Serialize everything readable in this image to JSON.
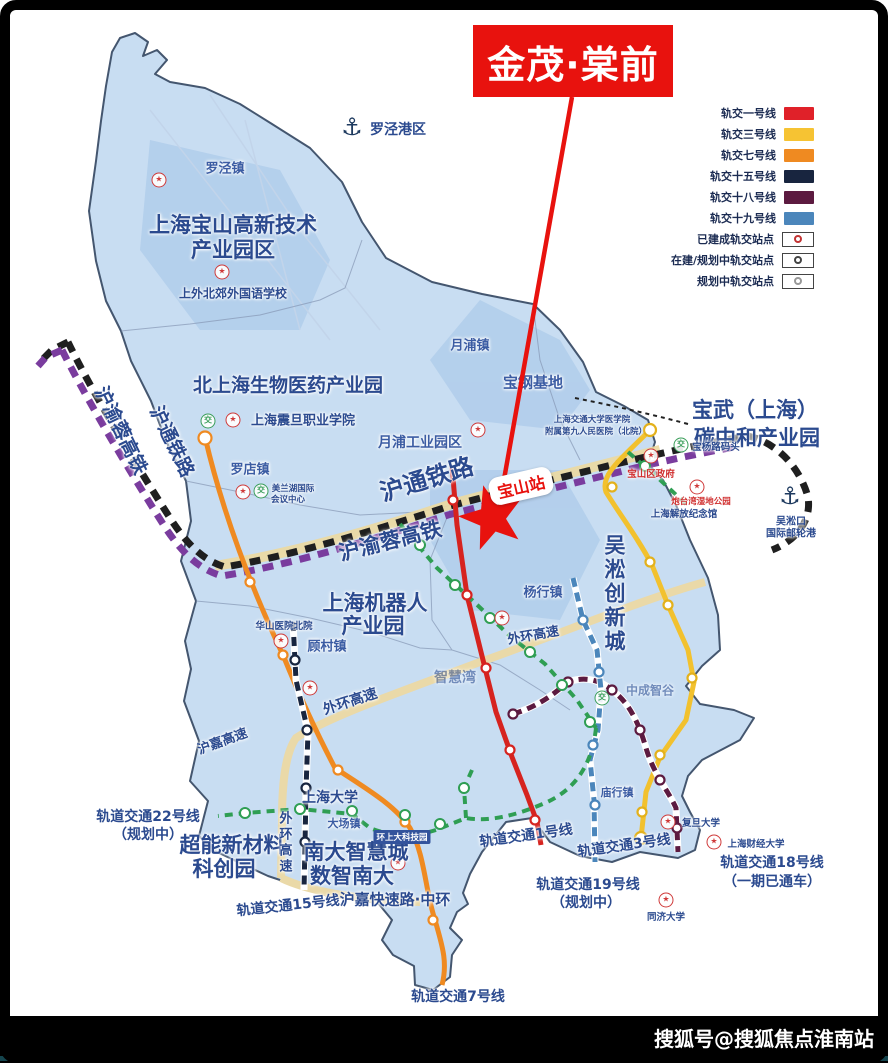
{
  "banner": {
    "title": "金茂·棠前"
  },
  "legend": {
    "lines": [
      {
        "label": "轨交一号线",
        "color": "#e02129"
      },
      {
        "label": "轨交三号线",
        "color": "#f6c333"
      },
      {
        "label": "轨交七号线",
        "color": "#ef8a21"
      },
      {
        "label": "轨交十五号线",
        "color": "#18253f"
      },
      {
        "label": "轨交十八号线",
        "color": "#5c1a40"
      },
      {
        "label": "轨交十九号线",
        "color": "#4b86bb"
      }
    ],
    "markers": [
      {
        "label": "已建成轨交站点"
      },
      {
        "label": "在建/规划中轨交站点"
      },
      {
        "label": "规划中轨交站点"
      }
    ]
  },
  "callout": {
    "station": "宝山站"
  },
  "parks": {
    "gaoxin1": "上海宝山高新技术",
    "gaoxin2": "产业园区",
    "biomed": "北上海生物医药产业园",
    "baowu1": "宝武（上海）",
    "baowu2": "碳中和产业园",
    "robot1": "上海机器人",
    "robot2": "产业园",
    "wusong": "吴淞创新城",
    "chaoneng1": "超能新材料",
    "chaoneng2": "科创园",
    "nanda1": "南大智慧城",
    "nanda2": "数智南大"
  },
  "towns": {
    "luojing": "罗泾镇",
    "luodian": "罗店镇",
    "yuepu": "月浦镇",
    "gucun": "顾村镇",
    "yanghang": "杨行镇",
    "dachang": "大场镇",
    "miaohang": "庙行镇"
  },
  "areas": {
    "baogang": "宝钢基地",
    "yuepu_park": "月浦工业园区",
    "zhihuiwan": "智慧湾",
    "zhongcheng": "中成智谷",
    "huanshangda": "环上大科技园"
  },
  "ports": {
    "luojing": "罗泾港区",
    "wusongkou1": "吴淞口",
    "wusongkou2": "国际邮轮港"
  },
  "railways": {
    "huyurong": "沪渝蓉高铁",
    "hutong": "沪通铁路"
  },
  "roads": {
    "waihuan": "外环高速",
    "hujia": "沪嘉高速",
    "zhonghuan": "沪嘉快速路·中环"
  },
  "metro": {
    "l22": "轨道交通22号线",
    "l22b": "（规划中）",
    "l15": "轨道交通15号线",
    "l7": "轨道交通7号线",
    "l1": "轨道交通1号线",
    "l3": "轨道交通3号线",
    "l19": "轨道交通19号线",
    "l19b": "（规划中）",
    "l18": "轨道交通18号线",
    "l18b": "（一期已通车）"
  },
  "pois": {
    "school": "上外北郊外国语学校",
    "college": "上海震旦职业学院",
    "meilan1": "美兰湖国际",
    "meilan2": "会议中心",
    "hosp1": "上海交通大学医学院",
    "hosp2": "附属第九人民医院（北院）",
    "gov": "宝山区政府",
    "huashan": "华山医院北院",
    "jiefang": "上海解放纪念馆",
    "baoyang": "宝杨路码头",
    "paotaiwan": "炮台湾湿地公园",
    "shu": "上海大学",
    "fudan": "复旦大学",
    "sufe": "上海财经大学",
    "tongji": "同济大学"
  },
  "icons": {
    "poi": "★",
    "interchange": "交",
    "anchor": "⚓"
  },
  "colors": {
    "banner": "#e8120e",
    "map_fill": "#c8ddf2",
    "line1": "#d6231f",
    "line3": "#f2c12e",
    "line7": "#ef8a21",
    "line15": "#18253f",
    "line18": "#5c1a40",
    "line19": "#4b86bb",
    "planned": "#2f9e53",
    "rail_black": "#1f1f1f",
    "rail_purple": "#7a3c9e"
  },
  "watermark": "搜狐号@搜狐焦点淮南站"
}
